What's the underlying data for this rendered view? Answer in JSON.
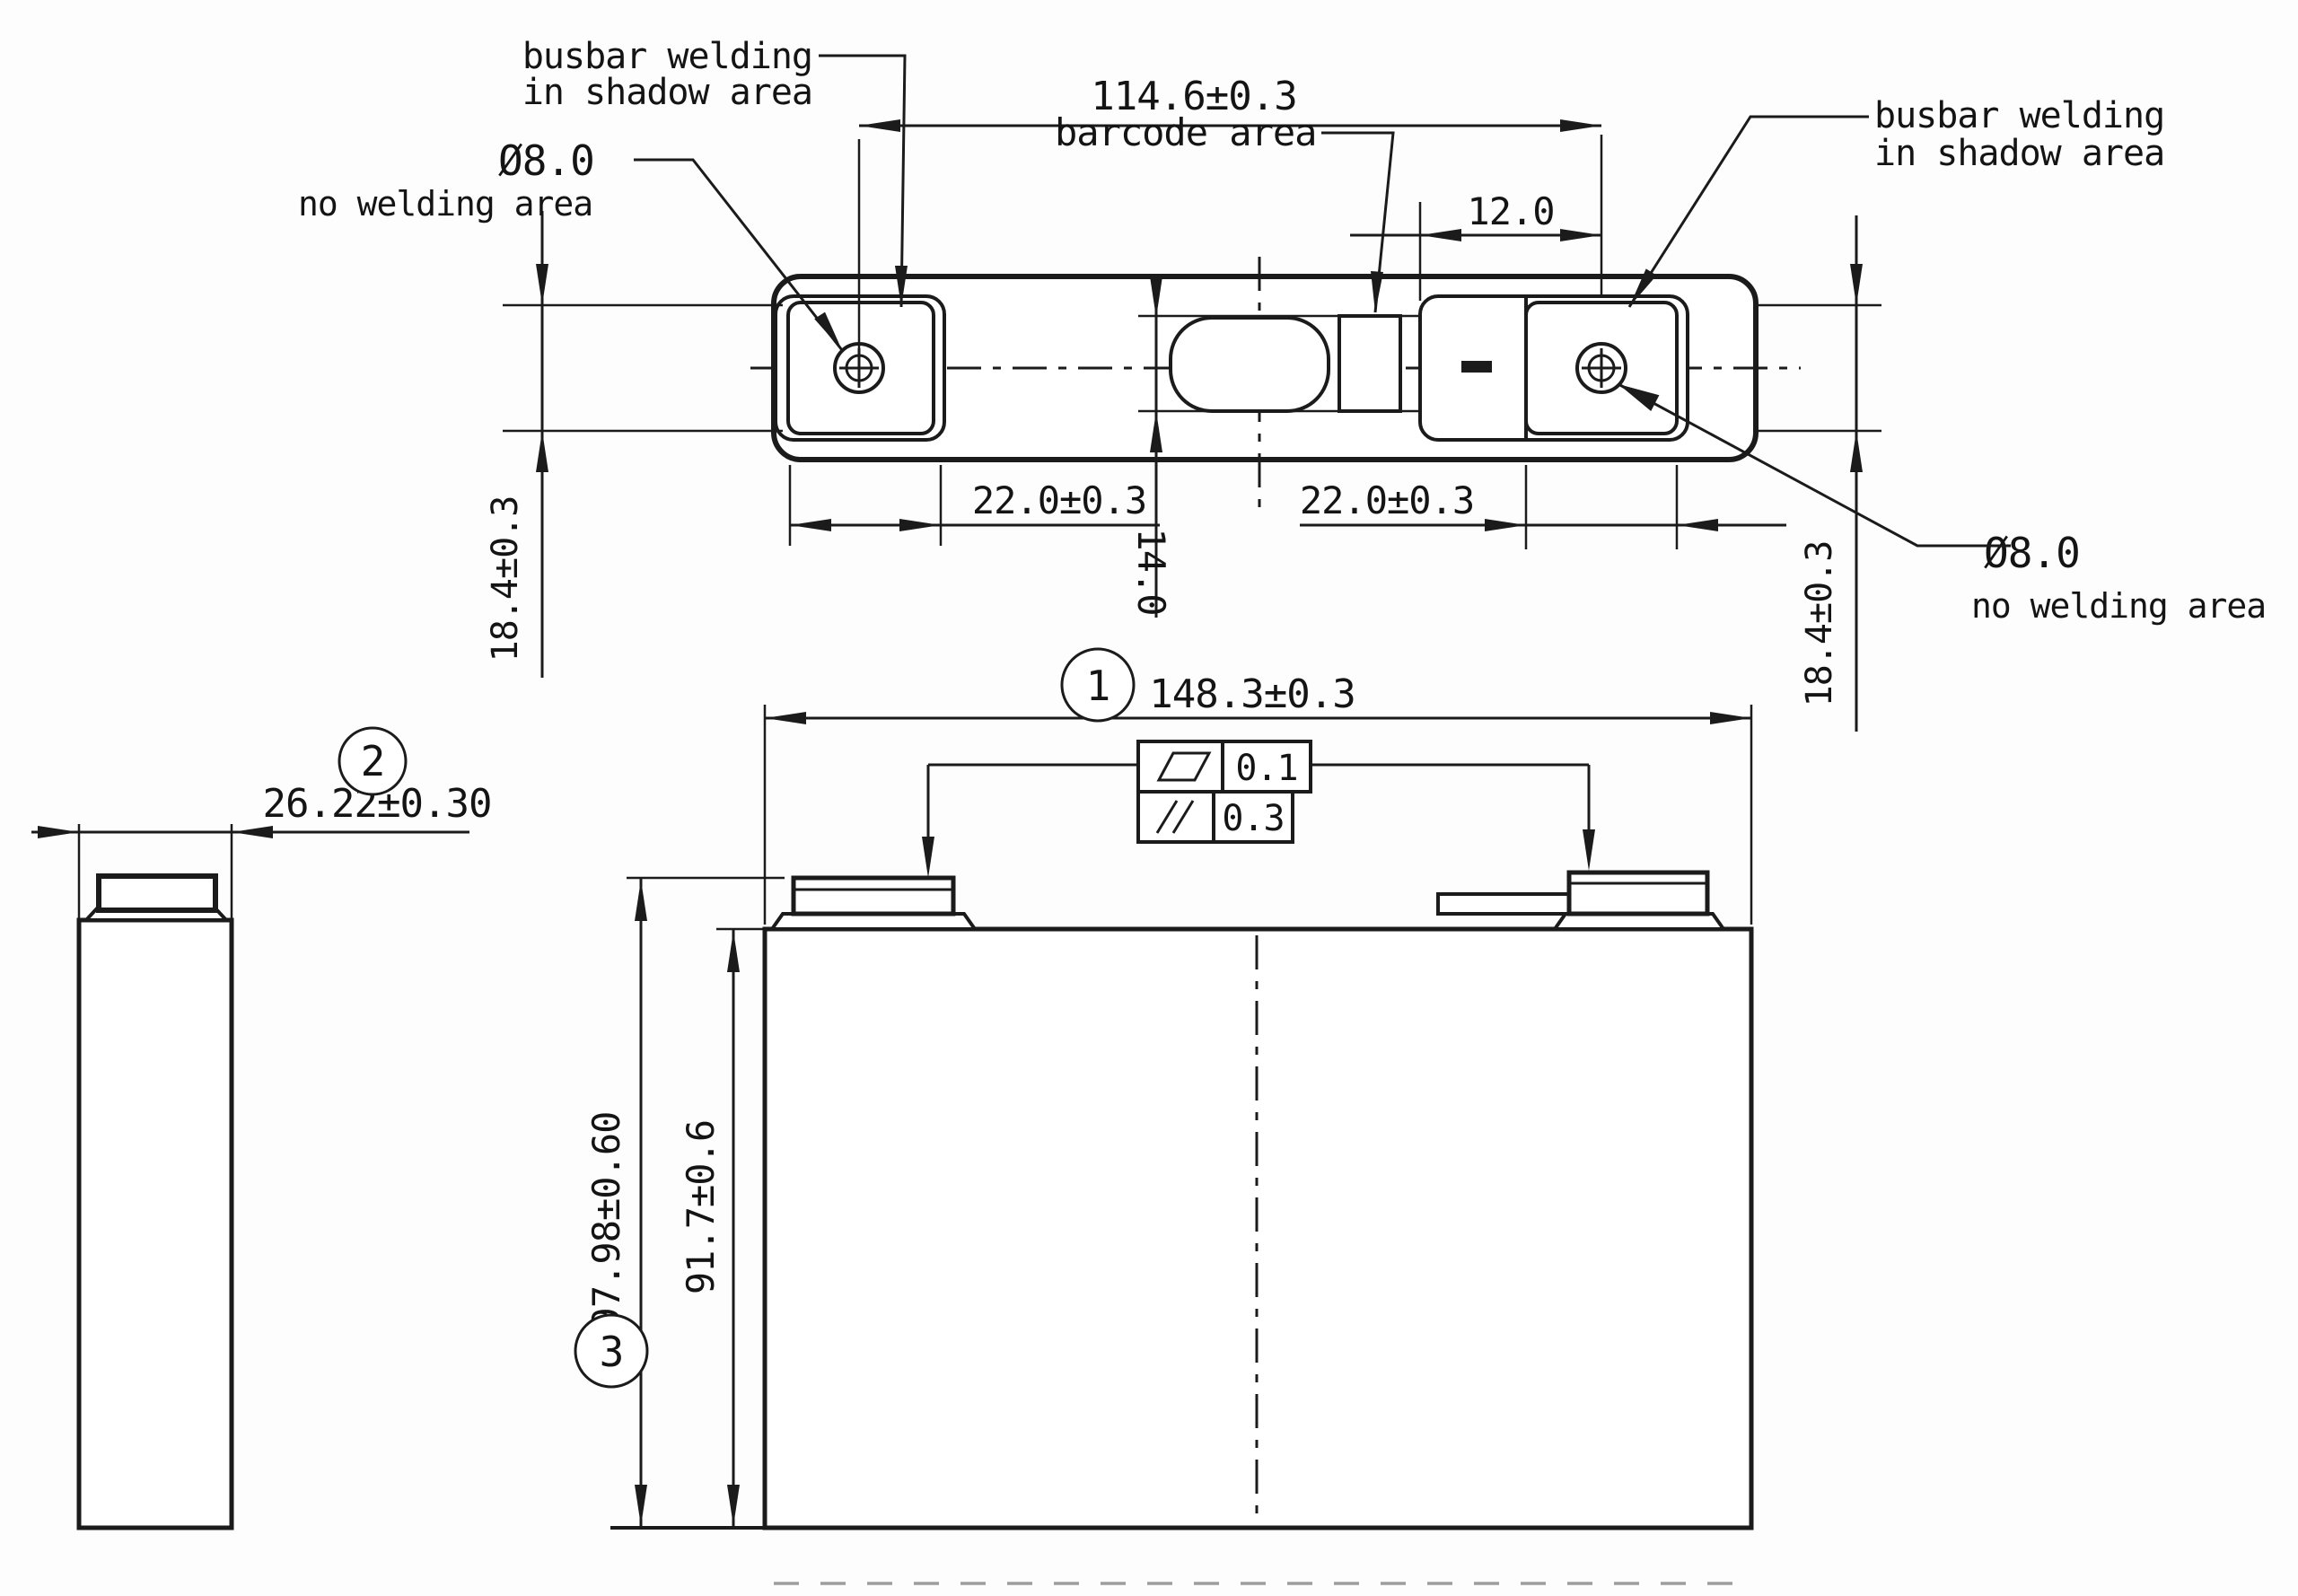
{
  "drawing": {
    "title": "prismatic battery cell outline drawing",
    "labels": {
      "busbar_left_line1": "busbar welding",
      "busbar_left_line2": "in shadow area",
      "no_welding_left_dia": "Ø8.0",
      "no_welding_left": "no welding area",
      "barcode_area": "barcode area",
      "busbar_right_line1": "busbar welding",
      "busbar_right_line2": "in shadow area",
      "no_welding_right_dia": "Ø8.0",
      "no_welding_right": "no welding area"
    },
    "dimensions": {
      "terminal_pitch": "114.6±0.3",
      "barcode_offset": "12.0",
      "weld_area_left": "22.0±0.3",
      "weld_area_right": "22.0±0.3",
      "vent_height": "14.0",
      "terminal_zone_left": "18.4±0.3",
      "terminal_zone_right": "18.4±0.3",
      "cell_width": "148.3±0.3",
      "cell_height_total": "97.98±0.60",
      "cell_height_can": "91.7±0.6",
      "cell_thickness": "26.22±0.30"
    },
    "tolerances": {
      "flatness_value": "0.1",
      "parallelism_value": "0.3"
    },
    "balloons": [
      "1",
      "2",
      "3"
    ],
    "colors": {
      "line": "#1b1b1b",
      "background": "#fdfdfd"
    }
  }
}
